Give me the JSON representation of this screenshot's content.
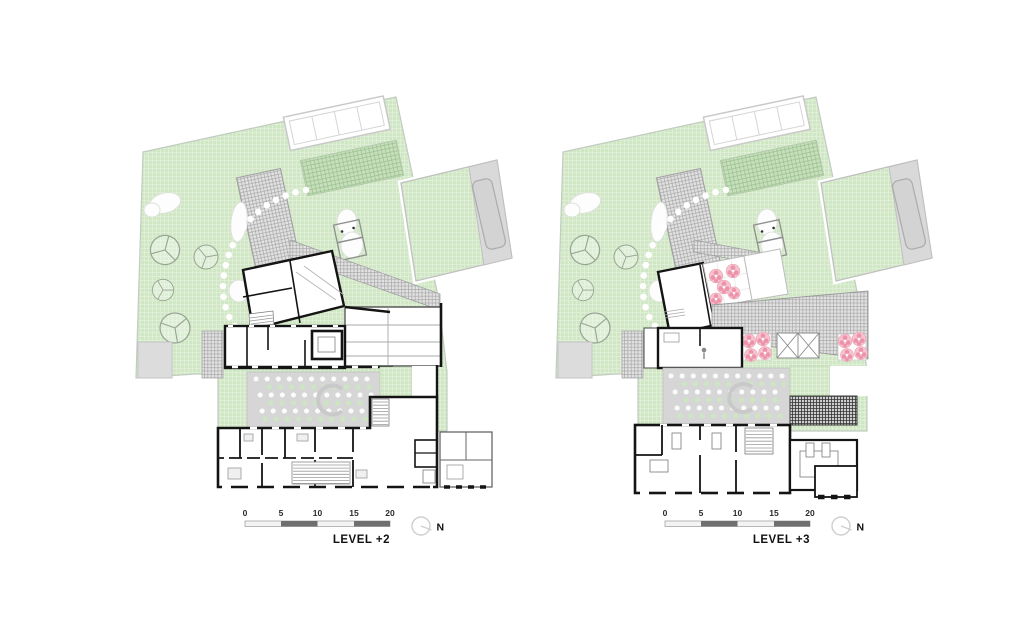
{
  "sheet": {
    "background": "#ffffff",
    "type": "architectural-roof-and-floor-plans"
  },
  "plans": [
    {
      "id": "level-plus-2",
      "label": "LEVEL +2"
    },
    {
      "id": "level-plus-3",
      "label": "LEVEL +3"
    }
  ],
  "scale_bar": {
    "ticks": [
      "0",
      "5",
      "10",
      "15",
      "20"
    ]
  },
  "north": {
    "label": "N"
  },
  "legend_colors": {
    "garden_green": "#cfe7c5",
    "hatch_green": "#c6e0bc",
    "roof_gray": "#d9d9d9",
    "courtyard_gray": "#d6d6d6",
    "wall_black": "#141414",
    "blossom_pink": "#f6c3cf",
    "blossom_pink_dark": "#ec93a9",
    "scale_dark": "#6f6f6f"
  }
}
